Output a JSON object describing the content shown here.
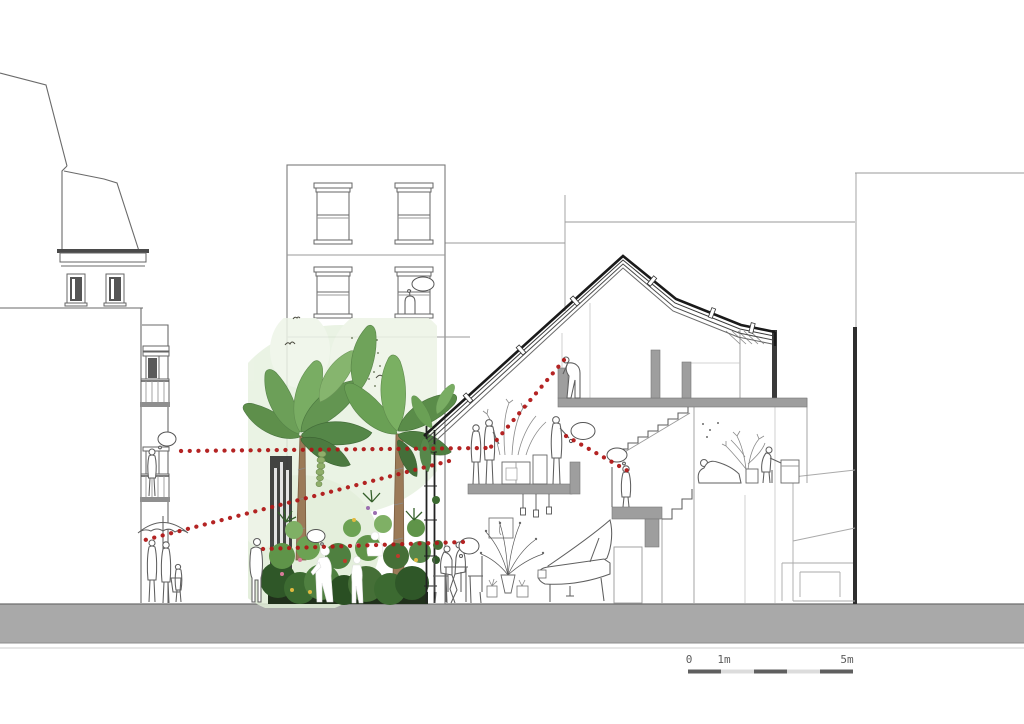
{
  "drawing": {
    "type": "architectural-section-perspective",
    "subject": "street section through terraced house with indoor tropical garden, sight lines between residents and neighbours",
    "scale_bar": {
      "labels": [
        "0",
        "1m",
        "5m"
      ]
    },
    "palette": {
      "sight_line_red": "#b01818",
      "ground_gray": "#a9a9a9",
      "poche_gray": "#9e9e9e",
      "outline_gray": "#6a6a6a",
      "party_wall_dark": "#2e2e2e",
      "wash_green": "#e7f1e0",
      "foliage_dark": "#2f5728",
      "foliage_mid": "#5e8f4b",
      "foliage_light": "#7ab062",
      "trunk_brown": "#9b7a58",
      "soil_dark": "#20301b"
    }
  }
}
